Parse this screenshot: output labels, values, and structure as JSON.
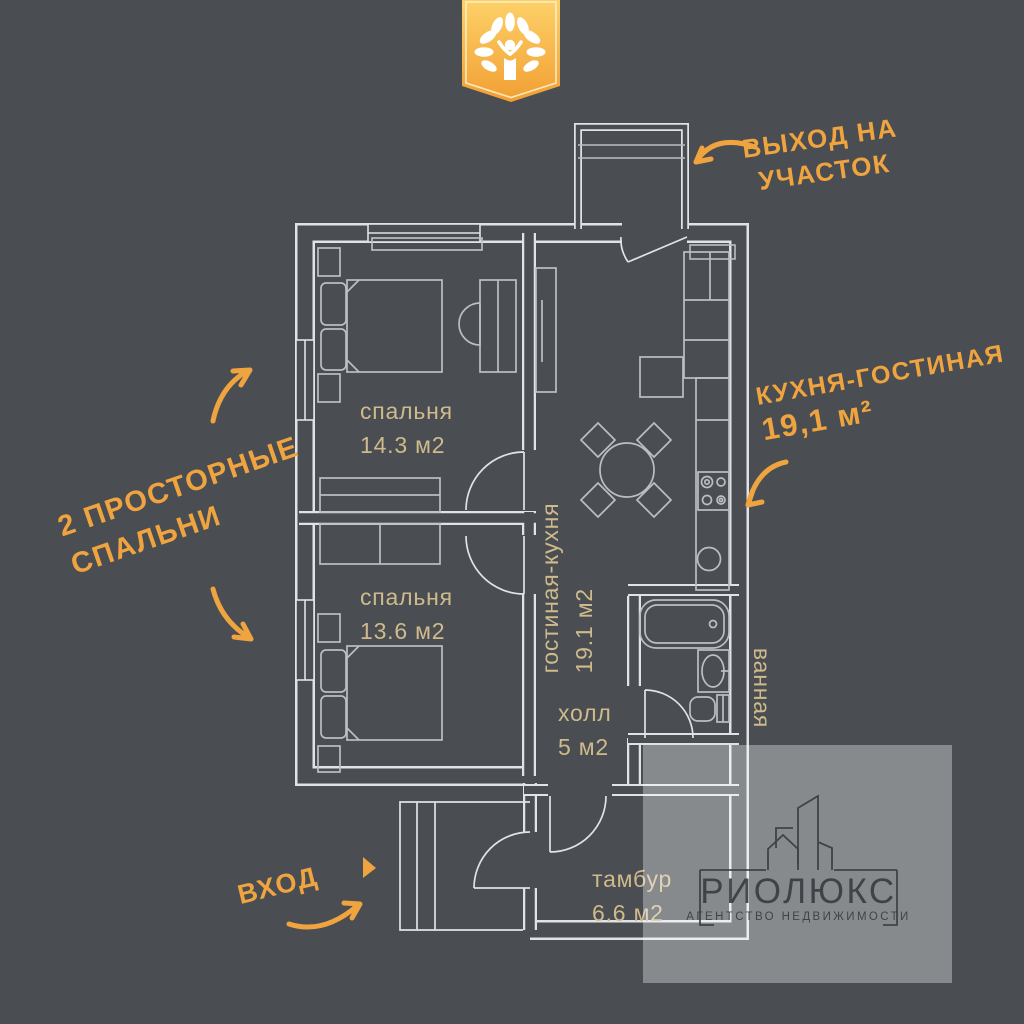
{
  "poster": {
    "badge": {
      "icon": "tree-person-emblem"
    },
    "rooms": {
      "bedroom1": {
        "name": "спальня",
        "area": "14.3 м2"
      },
      "bedroom2": {
        "name": "спальня",
        "area": "13.6 м2"
      },
      "living": {
        "name": "гостиная-кухня",
        "area": "19.1 м2"
      },
      "hall": {
        "name": "холл",
        "area": "5 м2"
      },
      "bathroom": {
        "name": "ванная"
      },
      "tambour": {
        "name": "тамбур",
        "area": "6.6 м2"
      }
    },
    "annotations": {
      "exit_line1": "ВЫХОД НА",
      "exit_line2": "УЧАСТОК",
      "kitchen_line1": "КУХНЯ-ГОСТИНАЯ",
      "kitchen_line2": "19,1 м²",
      "bedrooms_line1": "2 ПРОСТОРНЫЕ",
      "bedrooms_line2": "СПАЛЬНИ",
      "entrance": "ВХОД"
    },
    "watermark": {
      "brand": "РИОЛЮКС",
      "subtitle": "АГЕНТСТВО НЕДВИЖИМОСТИ"
    },
    "colors": {
      "background": "#4a4e52",
      "wall_line": "#dfe3e6",
      "furniture_line": "#b9bfc5",
      "room_label": "#cfba8c",
      "accent_orange": "#f0a43f",
      "badge_top": "#fdd169",
      "badge_bottom": "#f19f33",
      "watermark_ink": "#383c41"
    }
  }
}
